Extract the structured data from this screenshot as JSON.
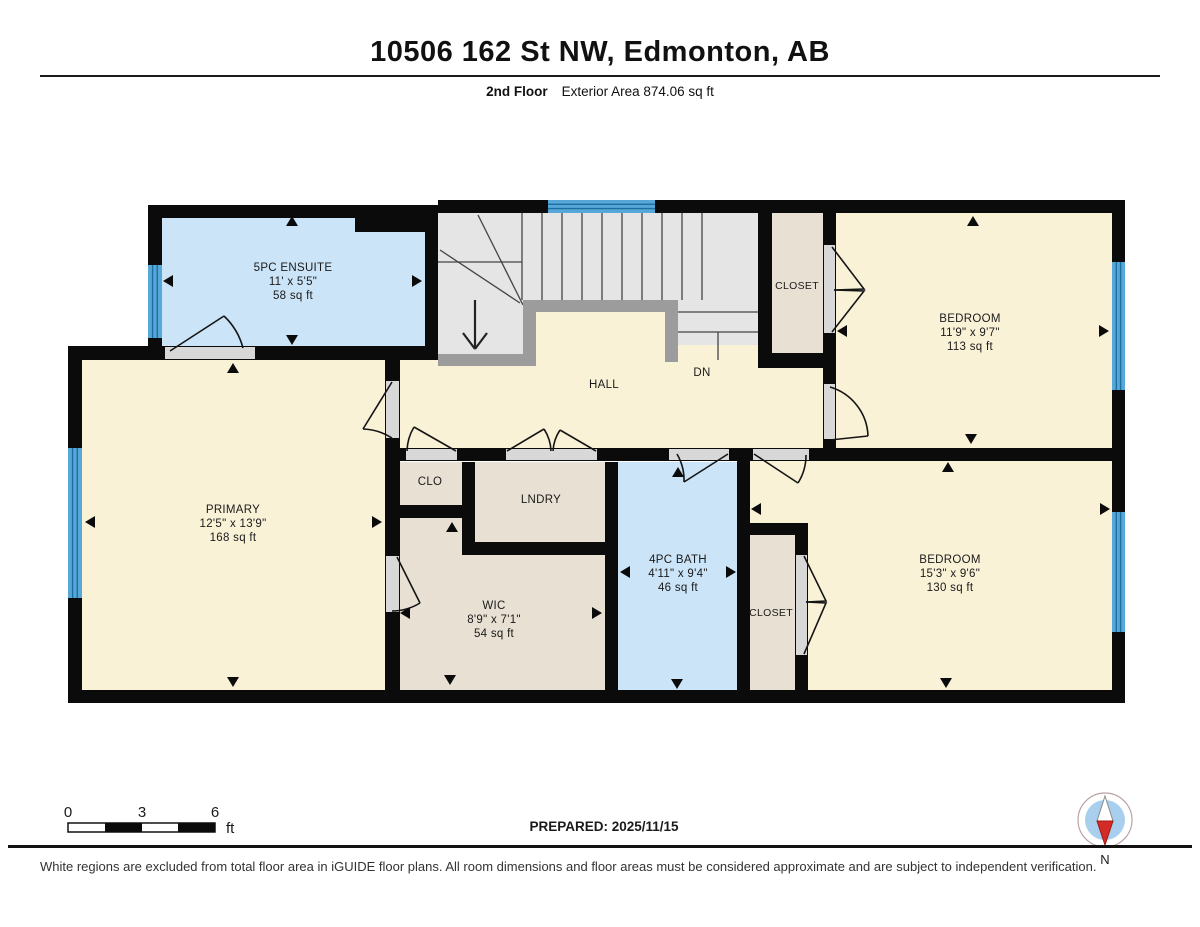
{
  "header": {
    "title": "10506 162 St NW, Edmonton, AB",
    "floor_label": "2nd Floor",
    "area_label": "Exterior Area 874.06 sq ft"
  },
  "rooms": {
    "ensuite": {
      "name": "5PC ENSUITE",
      "dims": "11' x 5'5\"",
      "area": "58 sq ft"
    },
    "primary": {
      "name": "PRIMARY",
      "dims": "12'5\" x 13'9\"",
      "area": "168 sq ft"
    },
    "bedroom_ne": {
      "name": "BEDROOM",
      "dims": "11'9\" x 9'7\"",
      "area": "113 sq ft"
    },
    "bedroom_se": {
      "name": "BEDROOM",
      "dims": "15'3\" x 9'6\"",
      "area": "130 sq ft"
    },
    "bath": {
      "name": "4PC BATH",
      "dims": "4'11\" x 9'4\"",
      "area": "46 sq ft"
    },
    "wic": {
      "name": "WIC",
      "dims": "8'9\" x 7'1\"",
      "area": "54 sq ft"
    },
    "hall": {
      "name": "HALL"
    },
    "laundry": {
      "name": "LNDRY"
    },
    "clo": {
      "name": "CLO"
    },
    "closet_ne": {
      "name": "CLOSET"
    },
    "closet_se": {
      "name": "CLOSET"
    },
    "stairs": {
      "down_label": "DN"
    }
  },
  "scale_bar": {
    "tick0": "0",
    "tick1": "3",
    "tick2": "6",
    "unit": "ft"
  },
  "prepared_label": "PREPARED: 2025/11/15",
  "compass": {
    "north_label": "N"
  },
  "footer": "White regions are excluded from total floor area in iGUIDE floor plans. All room dimensions and floor areas must be considered approximate and are subject to independent verification.",
  "colors": {
    "wall": "#0b0b0b",
    "room_warm": "#faf2d7",
    "room_blue": "#cbe4f7",
    "room_beige": "#e8e1d3",
    "stair_floor": "#e5e5e5",
    "railing": "#9c9c9c",
    "window_fill": "#57a8d8",
    "window_line": "#1c6fa0",
    "compass_needle_red": "#d42b26",
    "compass_face_blue": "#a8d0ee"
  }
}
